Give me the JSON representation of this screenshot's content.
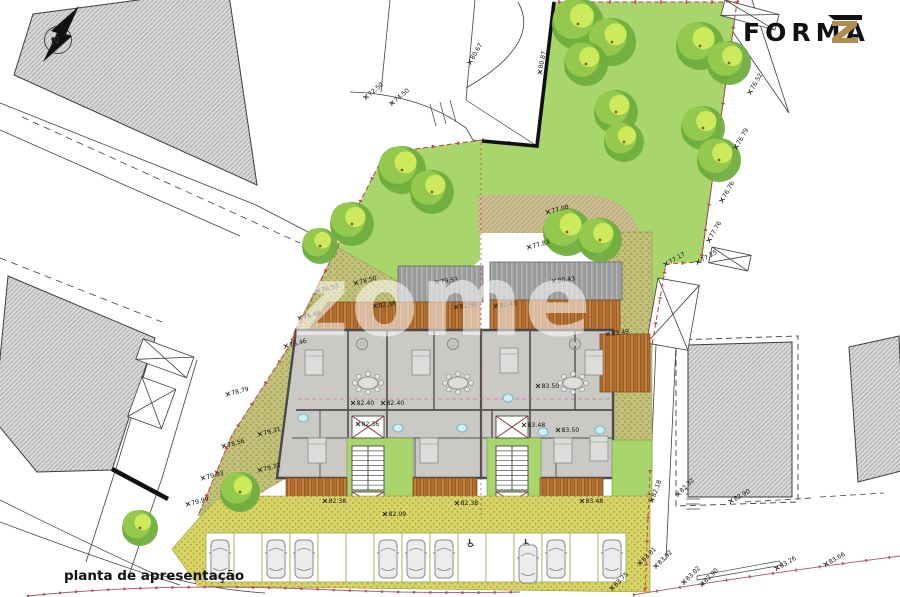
{
  "title": {
    "text": "planta de apresentação"
  },
  "watermark": {
    "text": "zome"
  },
  "logo": {
    "name": "FORMA",
    "symbol": "Z"
  },
  "compass": {
    "label": "N"
  },
  "colors": {
    "lawn": "#a8d56c",
    "tree_dark": "#6fae3e",
    "tree_mid": "#94c94d",
    "tree_light": "#cdea5c",
    "olive": "#c3c17a",
    "path_tan": "#cdbf93",
    "wood": "#c5803f",
    "roof_gray": "#adadad",
    "building_fill": "#cac9c5",
    "neighbor_fill": "#d9d9d9",
    "boundary_red": "#c04040",
    "road_red": "#b05060",
    "logo_gold": "#b08d4f",
    "bath_cyan": "#cdeef0"
  },
  "site": {
    "trees": [
      {
        "x": 578,
        "y": 24,
        "r": 26
      },
      {
        "x": 612,
        "y": 42,
        "r": 24
      },
      {
        "x": 586,
        "y": 64,
        "r": 22
      },
      {
        "x": 700,
        "y": 46,
        "r": 24
      },
      {
        "x": 729,
        "y": 63,
        "r": 22
      },
      {
        "x": 616,
        "y": 112,
        "r": 22
      },
      {
        "x": 703,
        "y": 128,
        "r": 22
      },
      {
        "x": 719,
        "y": 160,
        "r": 22
      },
      {
        "x": 624,
        "y": 142,
        "r": 20
      },
      {
        "x": 567,
        "y": 232,
        "r": 24
      },
      {
        "x": 600,
        "y": 240,
        "r": 22
      },
      {
        "x": 402,
        "y": 170,
        "r": 24
      },
      {
        "x": 432,
        "y": 192,
        "r": 22
      },
      {
        "x": 352,
        "y": 224,
        "r": 22
      },
      {
        "x": 320,
        "y": 246,
        "r": 18
      },
      {
        "x": 240,
        "y": 492,
        "r": 20
      },
      {
        "x": 140,
        "y": 528,
        "r": 18
      }
    ],
    "elevation_markers": [
      {
        "x": 750,
        "y": 92,
        "rot": -60,
        "t": "76.52"
      },
      {
        "x": 736,
        "y": 147,
        "rot": -60,
        "t": "76.79"
      },
      {
        "x": 722,
        "y": 200,
        "rot": -60,
        "t": "76.76"
      },
      {
        "x": 709,
        "y": 240,
        "rot": -60,
        "t": "77.76"
      },
      {
        "x": 698,
        "y": 262,
        "rot": -30,
        "t": "77.25"
      },
      {
        "x": 666,
        "y": 264,
        "rot": -30,
        "t": "77.17"
      },
      {
        "x": 548,
        "y": 212,
        "rot": -15,
        "t": "77.08"
      },
      {
        "x": 529,
        "y": 247,
        "rot": -15,
        "t": "77.83"
      },
      {
        "x": 470,
        "y": 62,
        "rot": -60,
        "t": "80.67"
      },
      {
        "x": 366,
        "y": 97,
        "rot": -40,
        "t": "72.50"
      },
      {
        "x": 392,
        "y": 103,
        "rot": -40,
        "t": "74.50"
      },
      {
        "x": 540,
        "y": 72,
        "rot": -80,
        "t": "80.87"
      },
      {
        "x": 318,
        "y": 291,
        "rot": -15,
        "t": "76.53"
      },
      {
        "x": 356,
        "y": 283,
        "rot": -15,
        "t": "78.50"
      },
      {
        "x": 300,
        "y": 318,
        "rot": -15,
        "t": "76.48"
      },
      {
        "x": 286,
        "y": 346,
        "rot": -15,
        "t": "76.46"
      },
      {
        "x": 228,
        "y": 394,
        "rot": -15,
        "t": "78.79"
      },
      {
        "x": 224,
        "y": 446,
        "rot": -15,
        "t": "78.56"
      },
      {
        "x": 260,
        "y": 434,
        "rot": -15,
        "t": "79.31"
      },
      {
        "x": 260,
        "y": 470,
        "rot": -15,
        "t": "79.31"
      },
      {
        "x": 203,
        "y": 478,
        "rot": -15,
        "t": "79.83"
      },
      {
        "x": 188,
        "y": 504,
        "rot": -15,
        "t": "79.99"
      },
      {
        "x": 437,
        "y": 282,
        "rot": -8,
        "t": "79.53"
      },
      {
        "x": 554,
        "y": 281,
        "rot": -8,
        "t": "80.43"
      },
      {
        "x": 375,
        "y": 306,
        "rot": -8,
        "t": "82.38"
      },
      {
        "x": 456,
        "y": 307,
        "rot": -8,
        "t": "82.56"
      },
      {
        "x": 496,
        "y": 306,
        "rot": -8,
        "t": "82.46"
      },
      {
        "x": 608,
        "y": 334,
        "rot": -8,
        "t": "83.49"
      },
      {
        "x": 353,
        "y": 403,
        "rot": 0,
        "t": "82.40"
      },
      {
        "x": 383,
        "y": 403,
        "rot": 0,
        "t": "82.40"
      },
      {
        "x": 358,
        "y": 424,
        "rot": 0,
        "t": "82.36"
      },
      {
        "x": 538,
        "y": 386,
        "rot": 0,
        "t": "83.50"
      },
      {
        "x": 524,
        "y": 425,
        "rot": 0,
        "t": "83.48"
      },
      {
        "x": 558,
        "y": 430,
        "rot": 0,
        "t": "83.50"
      },
      {
        "x": 325,
        "y": 501,
        "rot": 0,
        "t": "82.38"
      },
      {
        "x": 457,
        "y": 503,
        "rot": 0,
        "t": "82.38"
      },
      {
        "x": 582,
        "y": 501,
        "rot": 0,
        "t": "83.48"
      },
      {
        "x": 385,
        "y": 514,
        "rot": 0,
        "t": "82.09"
      },
      {
        "x": 652,
        "y": 500,
        "rot": -70,
        "t": "82.18"
      },
      {
        "x": 678,
        "y": 494,
        "rot": -45,
        "t": "82.32"
      },
      {
        "x": 731,
        "y": 501,
        "rot": -30,
        "t": "82.90"
      },
      {
        "x": 612,
        "y": 588,
        "rot": -45,
        "t": "83.75"
      },
      {
        "x": 640,
        "y": 563,
        "rot": -45,
        "t": "83.81"
      },
      {
        "x": 656,
        "y": 566,
        "rot": -45,
        "t": "83.92"
      },
      {
        "x": 684,
        "y": 582,
        "rot": -45,
        "t": "83.02"
      },
      {
        "x": 702,
        "y": 584,
        "rot": -45,
        "t": "82.90"
      },
      {
        "x": 777,
        "y": 568,
        "rot": -30,
        "t": "83.26"
      },
      {
        "x": 826,
        "y": 564,
        "rot": -30,
        "t": "83.66"
      }
    ],
    "parking": {
      "handicap_symbol": "♿",
      "stall_x0": 206,
      "stall_w": 28,
      "stall_y": 533,
      "stall_h": 49,
      "stalls": [
        "car",
        "empty",
        "car",
        "car",
        "empty",
        "empty",
        "car",
        "car",
        "car",
        "hc",
        "empty",
        "hc-car",
        "car",
        "empty",
        "car"
      ]
    },
    "stairs": [
      {
        "x": 352,
        "y": 446
      },
      {
        "x": 496,
        "y": 446
      }
    ],
    "elevators": [
      {
        "x": 352,
        "y": 416,
        "w": 32,
        "h": 22
      },
      {
        "x": 352,
        "y": 492,
        "w": 32,
        "h": 18
      },
      {
        "x": 496,
        "y": 416,
        "w": 32,
        "h": 22
      },
      {
        "x": 496,
        "y": 492,
        "w": 32,
        "h": 18
      }
    ],
    "furniture": {
      "dining": [
        [
          368,
          383
        ],
        [
          458,
          383
        ],
        [
          573,
          383
        ]
      ],
      "round_tables": [
        [
          362,
          344
        ],
        [
          453,
          344
        ],
        [
          575,
          344
        ]
      ],
      "beds": [
        [
          305,
          350
        ],
        [
          412,
          350
        ],
        [
          500,
          348
        ],
        [
          585,
          350
        ],
        [
          308,
          438
        ],
        [
          420,
          438
        ],
        [
          554,
          438
        ],
        [
          590,
          436
        ]
      ],
      "baths": [
        [
          303,
          418
        ],
        [
          398,
          428
        ],
        [
          462,
          428
        ],
        [
          508,
          398
        ],
        [
          543,
          432
        ],
        [
          600,
          430
        ]
      ]
    }
  }
}
